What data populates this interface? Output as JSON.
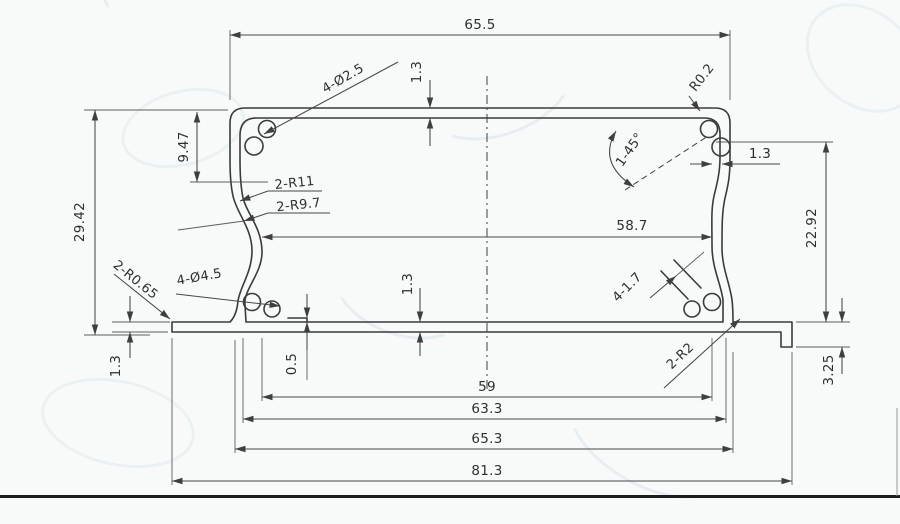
{
  "drawing": {
    "type": "extrusion-profile-cross-section",
    "dimensions": {
      "top_width": "65.5",
      "top_wall": "1.3",
      "corner_holes": "4-Ø2.5",
      "corner_radius": "R0.2",
      "chamfer": "1-45°",
      "right_wall": "1.3",
      "boss_depth": "9.47",
      "left_height": "29.42",
      "s_radius_outer": "2-R11",
      "s_radius_inner": "2-R9.7",
      "inner_width": "58.7",
      "right_height": "22.92",
      "flange_fillet_left": "2-R0.65",
      "base_holes": "4-Ø4.5",
      "flange_thickness": "1.3",
      "floor_step": "0.5",
      "bottom_wall": "1.3",
      "slot": "4-1.7",
      "flange_fillet_right": "2-R2",
      "flange_lip": "3.25",
      "floor_width": "59",
      "base_width_inner": "63.3",
      "base_width_outer": "65.3",
      "overall_width": "81.3"
    },
    "colors": {
      "ink": "#3b3b3b",
      "paper": "#f7faf9",
      "watermark": "#7da5c8"
    }
  }
}
